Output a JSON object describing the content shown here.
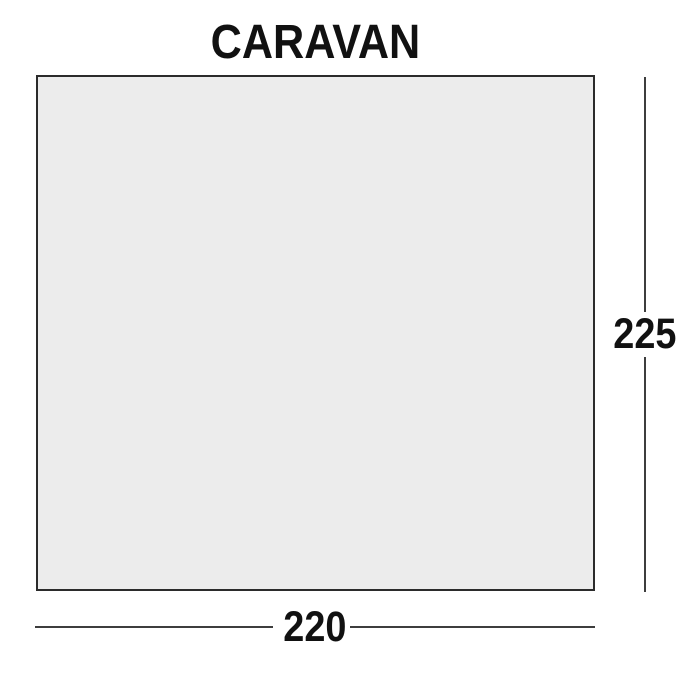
{
  "diagram": {
    "title": "CARAVAN",
    "height_label": "225",
    "width_label": "220"
  },
  "colors": {
    "background": "#ffffff",
    "shape_fill": "#ececec",
    "shape_border": "#2b2b2b",
    "dimension_line": "#3d3d3d",
    "text": "#111111"
  }
}
